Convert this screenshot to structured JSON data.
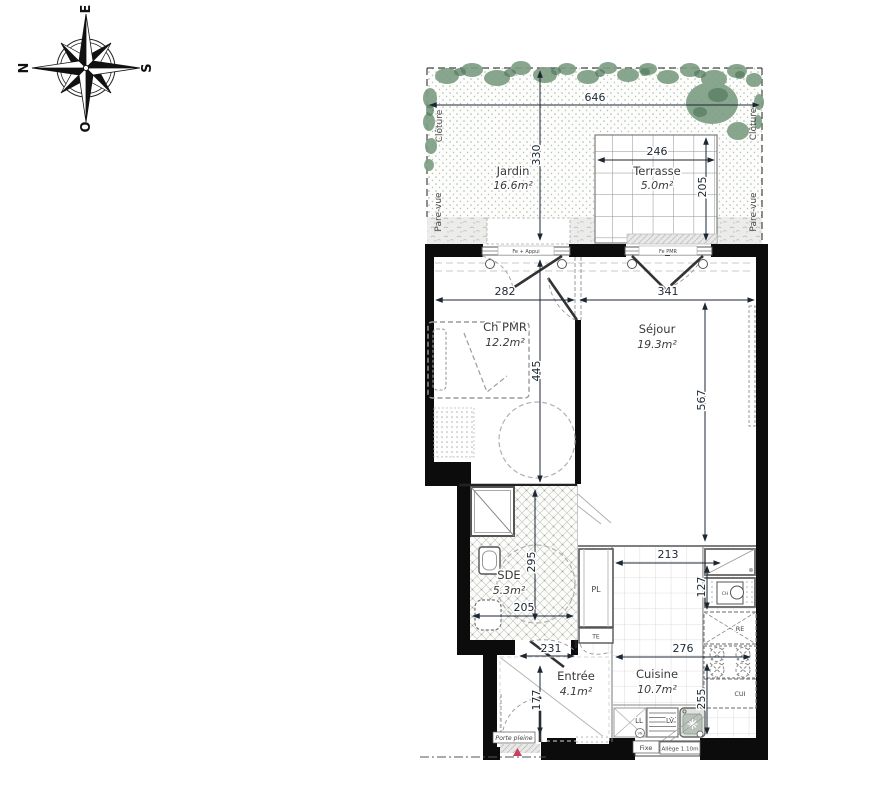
{
  "compass": {
    "n": "N",
    "e": "E",
    "s": "S",
    "o": "O"
  },
  "exterior": {
    "garden": {
      "name": "Jardin",
      "area": "16.6m²",
      "dim_width": "646",
      "dim_depth": "330"
    },
    "terrace": {
      "name": "Terrasse",
      "area": "5.0m²",
      "dim_width": "246",
      "dim_depth": "205"
    },
    "fence": "Clôture",
    "screen": "Pare-vue"
  },
  "rooms": {
    "bedroom": {
      "name": "Ch PMR",
      "area": "12.2m²",
      "dim_width": "282",
      "dim_depth": "445"
    },
    "living": {
      "name": "Séjour",
      "area": "19.3m²",
      "dim_width": "341",
      "dim_depth": "567"
    },
    "shower_room": {
      "name": "SDE",
      "area": "5.3m²",
      "dim_depth": "295",
      "dim_width": "205",
      "dim_door": "231"
    },
    "entry": {
      "name": "Entrée",
      "area": "4.1m²",
      "dim_depth": "177"
    },
    "kitchen": {
      "name": "Cuisine",
      "area": "10.7m²",
      "dim_width": "276",
      "dim_depth": "255",
      "dim_counter": "213",
      "dim_counter_depth": "127"
    }
  },
  "equipment": {
    "closet": "PL",
    "elec": "TE",
    "fridge": "RE",
    "cook": "CUI",
    "heater": "CH",
    "washer": "LL",
    "dishwasher": "LV",
    "vent": "VN"
  },
  "annotations": {
    "door": "Porte pleine",
    "window_fixed": "Fixe",
    "window_sill": "Allège 1.10m",
    "window_bedroom": "Fe + Appui",
    "window_living": "Fe PMR"
  },
  "colors": {
    "vegetation": "#7d9f84",
    "vegetation_dark": "#567d60",
    "south": "#b4651e",
    "marker": "#c8415f"
  }
}
